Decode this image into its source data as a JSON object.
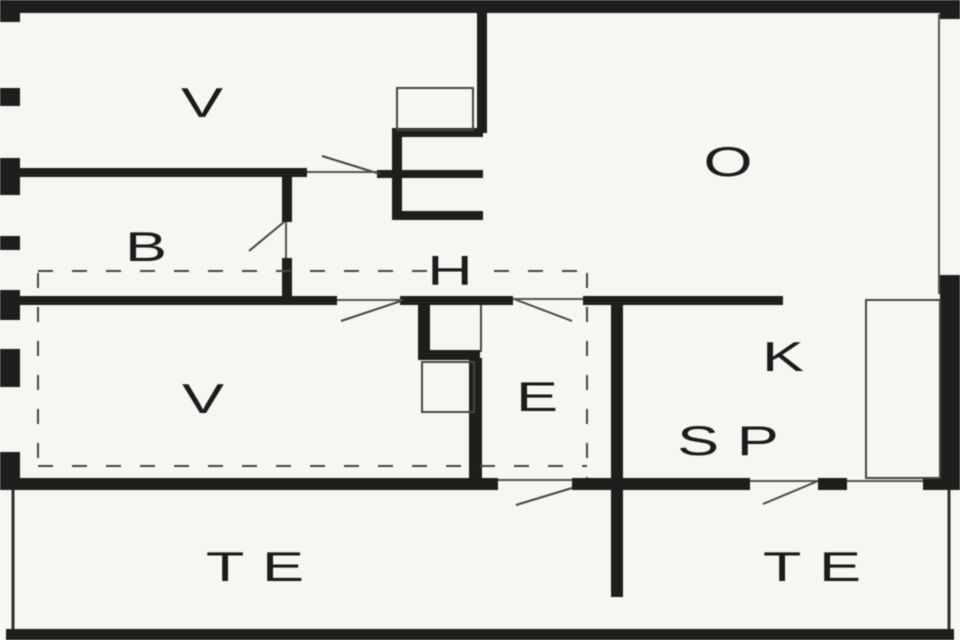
{
  "colors": {
    "background": "#f7f6f2",
    "wall": "#1e1e1c",
    "thin_line": "#45443f"
  },
  "rooms": [
    {
      "id": "room-v-top",
      "label": "V"
    },
    {
      "id": "room-o",
      "label": "O"
    },
    {
      "id": "room-b",
      "label": "B"
    },
    {
      "id": "room-h",
      "label": "H"
    },
    {
      "id": "room-v-lower",
      "label": "V"
    },
    {
      "id": "room-e",
      "label": "E"
    },
    {
      "id": "room-k",
      "label": "K"
    },
    {
      "id": "room-sp",
      "label": "SP"
    },
    {
      "id": "room-te-left",
      "label": "TE"
    },
    {
      "id": "room-te-right",
      "label": "TE"
    }
  ]
}
